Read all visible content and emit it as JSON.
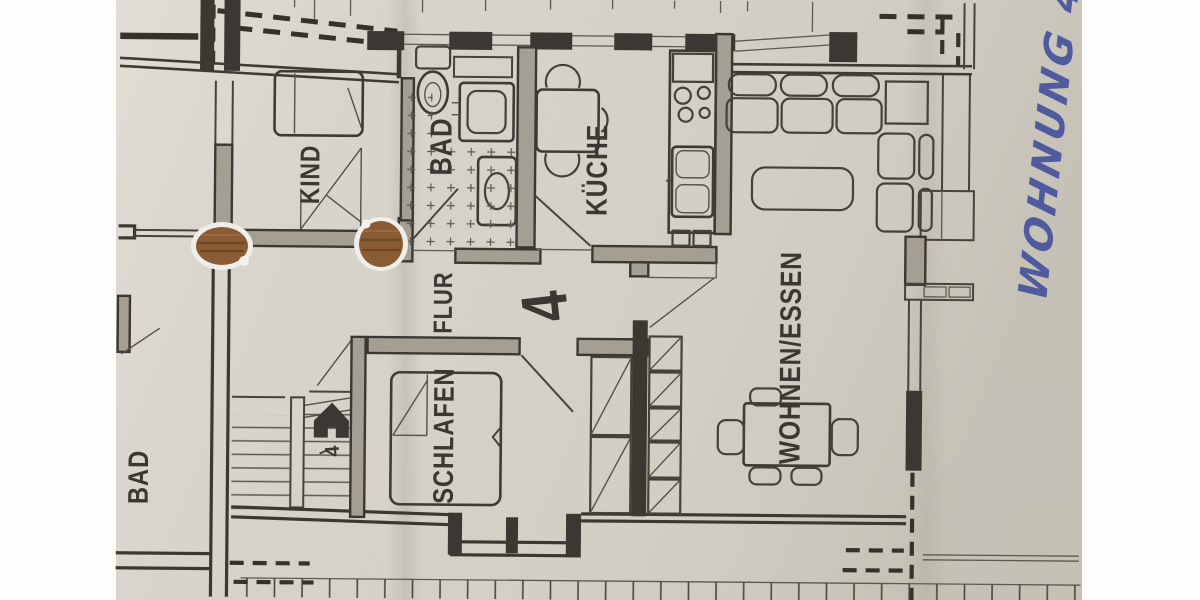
{
  "plan": {
    "apartment_number": "4",
    "stairwell_number": "4",
    "rooms": {
      "kind": "KIND",
      "bad": "BAD",
      "kueche": "KÜCHE",
      "flur": "FLUR",
      "schlafen": "SCHLAFEN",
      "wohnen_essen": "WOHNEN/ESSEN",
      "bad_neighbor": "BAD"
    }
  },
  "annotations": {
    "handwritten_note": "WOHNUNG 4"
  },
  "colors": {
    "paper": "#d6d2c9",
    "ink": "#3b3833",
    "handwriting_ink": "#3f4c9c",
    "punch_hole": "#8a5c33"
  }
}
